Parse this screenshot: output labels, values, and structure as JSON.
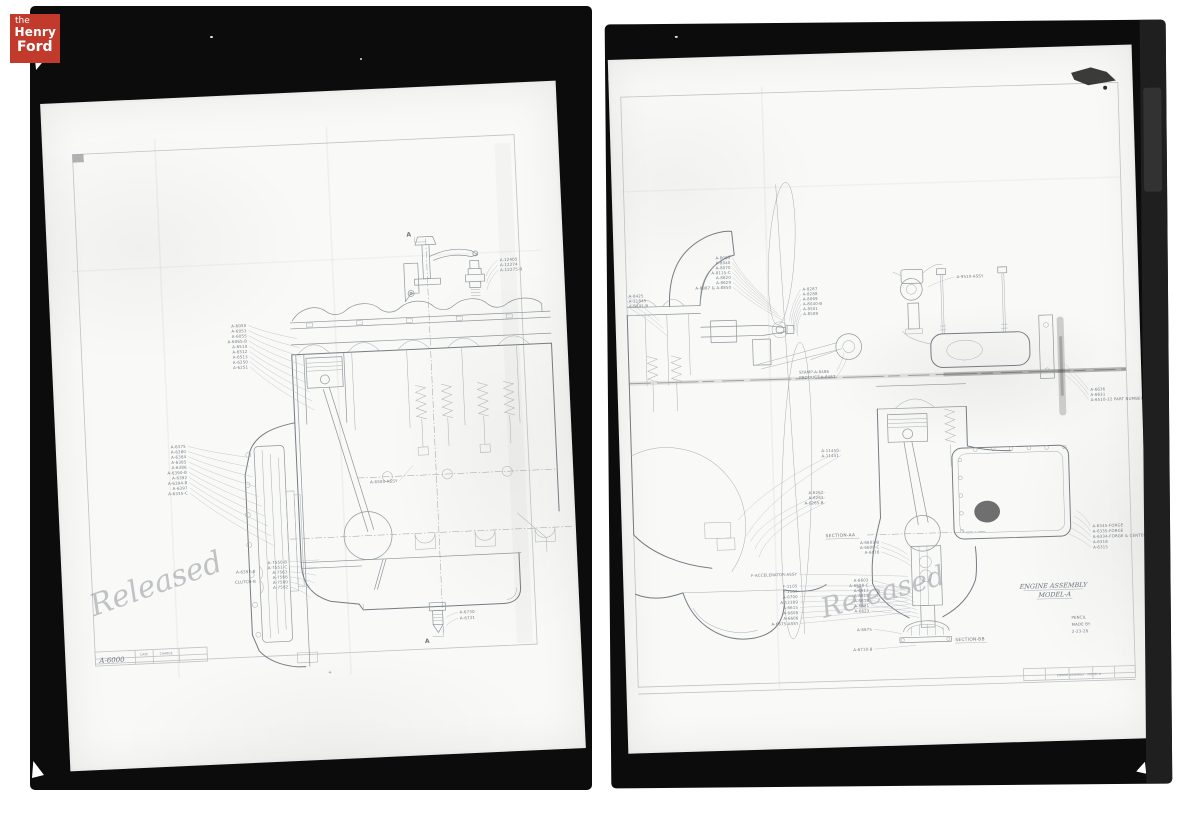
{
  "page": {
    "background": "#ffffff"
  },
  "colors": {
    "film": "#0c0c0c",
    "sheet": "#f9f9f7",
    "film_edge_strip": "#1f1f1f",
    "pencil_line": "#8f969c",
    "logo_red": "#c23a2c"
  },
  "logo": {
    "the": "the",
    "henry": "Henry",
    "ford": "Ford",
    "bg_color": "#c23a2c",
    "text_color": "#ffffff"
  },
  "left_plate": {
    "section_marker_top": "A",
    "section_marker_bottom": "A",
    "plus_mark": "+",
    "handwriting": "Released",
    "title_block": {
      "number": "A-6000",
      "cell_a": "DATE",
      "cell_b": "CHANGE"
    },
    "clusters": [
      {
        "x": 196,
        "y": 232,
        "lh": 5.2,
        "anchor": "end",
        "bend": -8,
        "to": [
          246,
          246,
          260,
          318
        ],
        "labels": [
          "A-6050",
          "A-6051",
          "A-6055",
          "A-6065-B",
          "A-6510",
          "A-6512",
          "A-6513",
          "A-6250",
          "A-6251"
        ]
      },
      {
        "x": 130,
        "y": 350,
        "lh": 5.2,
        "anchor": "end",
        "bend": -8,
        "to": [
          190,
          362,
          214,
          452
        ],
        "labels": [
          "A-6375",
          "A-6380",
          "A-6384",
          "A-6385",
          "A-6386",
          "A-6390-B",
          "A-6392",
          "A-6394-B",
          "A-6397",
          "A-6335-C"
        ]
      },
      {
        "x": 226,
        "y": 470,
        "lh": 5,
        "anchor": "end",
        "bend": 6,
        "to": [
          258,
          468,
          248,
          506
        ],
        "labels": [
          "A-7550-B",
          "A-7551-C",
          "A-7563",
          "A-7566",
          "A-7580",
          "A-7502"
        ]
      },
      {
        "x": 194,
        "y": 478,
        "lh": 10,
        "anchor": "end",
        "labels": [
          "A-6397-B",
          "CLUTCH-B"
        ]
      },
      {
        "x": 452,
        "y": 178,
        "lh": 5,
        "anchor": "start",
        "bend": -4,
        "to": [
          438,
          192,
          438,
          206
        ],
        "labels": [
          "A-12405",
          "A-12274",
          "A-12275-B"
        ]
      },
      {
        "x": 340,
        "y": 394,
        "lh": 5,
        "anchor": "end",
        "to": [
          356,
          378,
          356,
          378
        ],
        "labels": [
          "A-6500-ASSY"
        ]
      },
      {
        "x": 396,
        "y": 528,
        "lh": 6,
        "anchor": "start",
        "bend": -4,
        "to": [
          382,
          532,
          382,
          540
        ],
        "labels": [
          "A-6730",
          "A-6731"
        ]
      }
    ]
  },
  "right_plate": {
    "title_line1": "ENGINE ASSEMBLY",
    "title_line2": "MODEL-A",
    "section_aa": "SECTION-AA",
    "section_bb": "SECTION-BB",
    "handwriting": "Released",
    "title_block": {
      "line1": "PENCIL",
      "line2": "MADE BY",
      "line3": "2-23-28",
      "strip": "ENGINE ASSEMBLY - MODEL A"
    },
    "clusters": [
      {
        "x": 118,
        "y": 204,
        "lh": 5,
        "anchor": "end",
        "bend": -6,
        "to": [
          152,
          244,
          170,
          268
        ],
        "labels": [
          "A-8005",
          "A-8040",
          "A-8070",
          "A-8115-C",
          "A-8620",
          "A-8629",
          "A-8887 & A-8850"
        ]
      },
      {
        "x": 190,
        "y": 238,
        "lh": 5,
        "anchor": "start",
        "bend": -4,
        "to": [
          176,
          268,
          184,
          284
        ],
        "labels": [
          "A-8287",
          "A-8288",
          "A-8069",
          "A-8040-B",
          "A-8501",
          "A-8508"
        ]
      },
      {
        "x": 14,
        "y": 240,
        "lh": 5,
        "anchor": "start",
        "bend": 4,
        "to": [
          44,
          264,
          52,
          280
        ],
        "labels": [
          "A-8425",
          "A-21845",
          "A-8441-B"
        ]
      },
      {
        "x": 184,
        "y": 322,
        "lh": 5.4,
        "anchor": "start",
        "lx": 222,
        "bend": 2,
        "to": [
          230,
          302,
          233,
          307
        ],
        "labels": [
          "STAMP-A-8486",
          "PRODUCT-A-8487"
        ]
      },
      {
        "x": 222,
        "y": 402,
        "lh": 5.2,
        "anchor": "end",
        "bend": -24,
        "to": [
          118,
          468,
          126,
          484
        ],
        "labels": [
          "A-11450",
          "A-11451"
        ]
      },
      {
        "x": 205,
        "y": 444,
        "lh": 5.2,
        "anchor": "end",
        "bend": -26,
        "to": [
          130,
          490,
          138,
          506
        ],
        "labels": [
          "A-6262",
          "A-6263",
          "A-6265-B"
        ]
      },
      {
        "x": 346,
        "y": 230,
        "lh": 5,
        "anchor": "start",
        "bend": -4,
        "to": [
          317,
          238,
          317,
          238
        ],
        "labels": [
          "A-9510-ASSY"
        ]
      },
      {
        "x": 478,
        "y": 348,
        "lh": 5.2,
        "anchor": "start",
        "bend": 4,
        "to": [
          448,
          316,
          452,
          330
        ],
        "labels": [
          "A-6636",
          "A-6631",
          "A-6510-22 PART NUMBER"
        ]
      },
      {
        "x": 476,
        "y": 486,
        "lh": 5.4,
        "anchor": "start",
        "bend": 4,
        "to": [
          460,
          468,
          452,
          492
        ],
        "labels": [
          "A-6345-FORGE",
          "A-6335-FORGE",
          "A-6334-FORGE & CENTER",
          "A-6318",
          "A-6315"
        ]
      },
      {
        "x": 176,
        "y": 526,
        "lh": 5,
        "anchor": "end",
        "bend": 14,
        "to": [
          288,
          530,
          288,
          530
        ],
        "labels": [
          "F-ACCELERATOR-ASSY"
        ]
      },
      {
        "x": 176,
        "y": 538,
        "lh": 5.4,
        "anchor": "end",
        "bend": 16,
        "to": [
          284,
          540,
          290,
          566
        ],
        "labels": [
          "F-1105",
          "F-1107",
          "A-6700",
          "A-12389",
          "A-6615",
          "A-6608",
          "A-6606",
          "A-6675-ASSY"
        ]
      },
      {
        "x": 248,
        "y": 534,
        "lh": 5.2,
        "anchor": "end",
        "bend": 8,
        "to": [
          292,
          548,
          298,
          572
        ],
        "labels": [
          "A-6603",
          "A-6608-C",
          "A-6613",
          "A-6616",
          "A-6618",
          "A-6621",
          "A-6623"
        ]
      },
      {
        "x": 260,
        "y": 496,
        "lh": 5,
        "anchor": "end",
        "bend": 6,
        "to": [
          288,
          508,
          292,
          520
        ],
        "labels": [
          "A-6603-B",
          "A-6608-C",
          "A-6616"
        ]
      },
      {
        "x": 250,
        "y": 584,
        "lh": 20,
        "anchor": "end",
        "bend": 4,
        "to": [
          280,
          588,
          294,
          600
        ],
        "labels": [
          "A-6675",
          "A-6710-B"
        ]
      }
    ]
  }
}
